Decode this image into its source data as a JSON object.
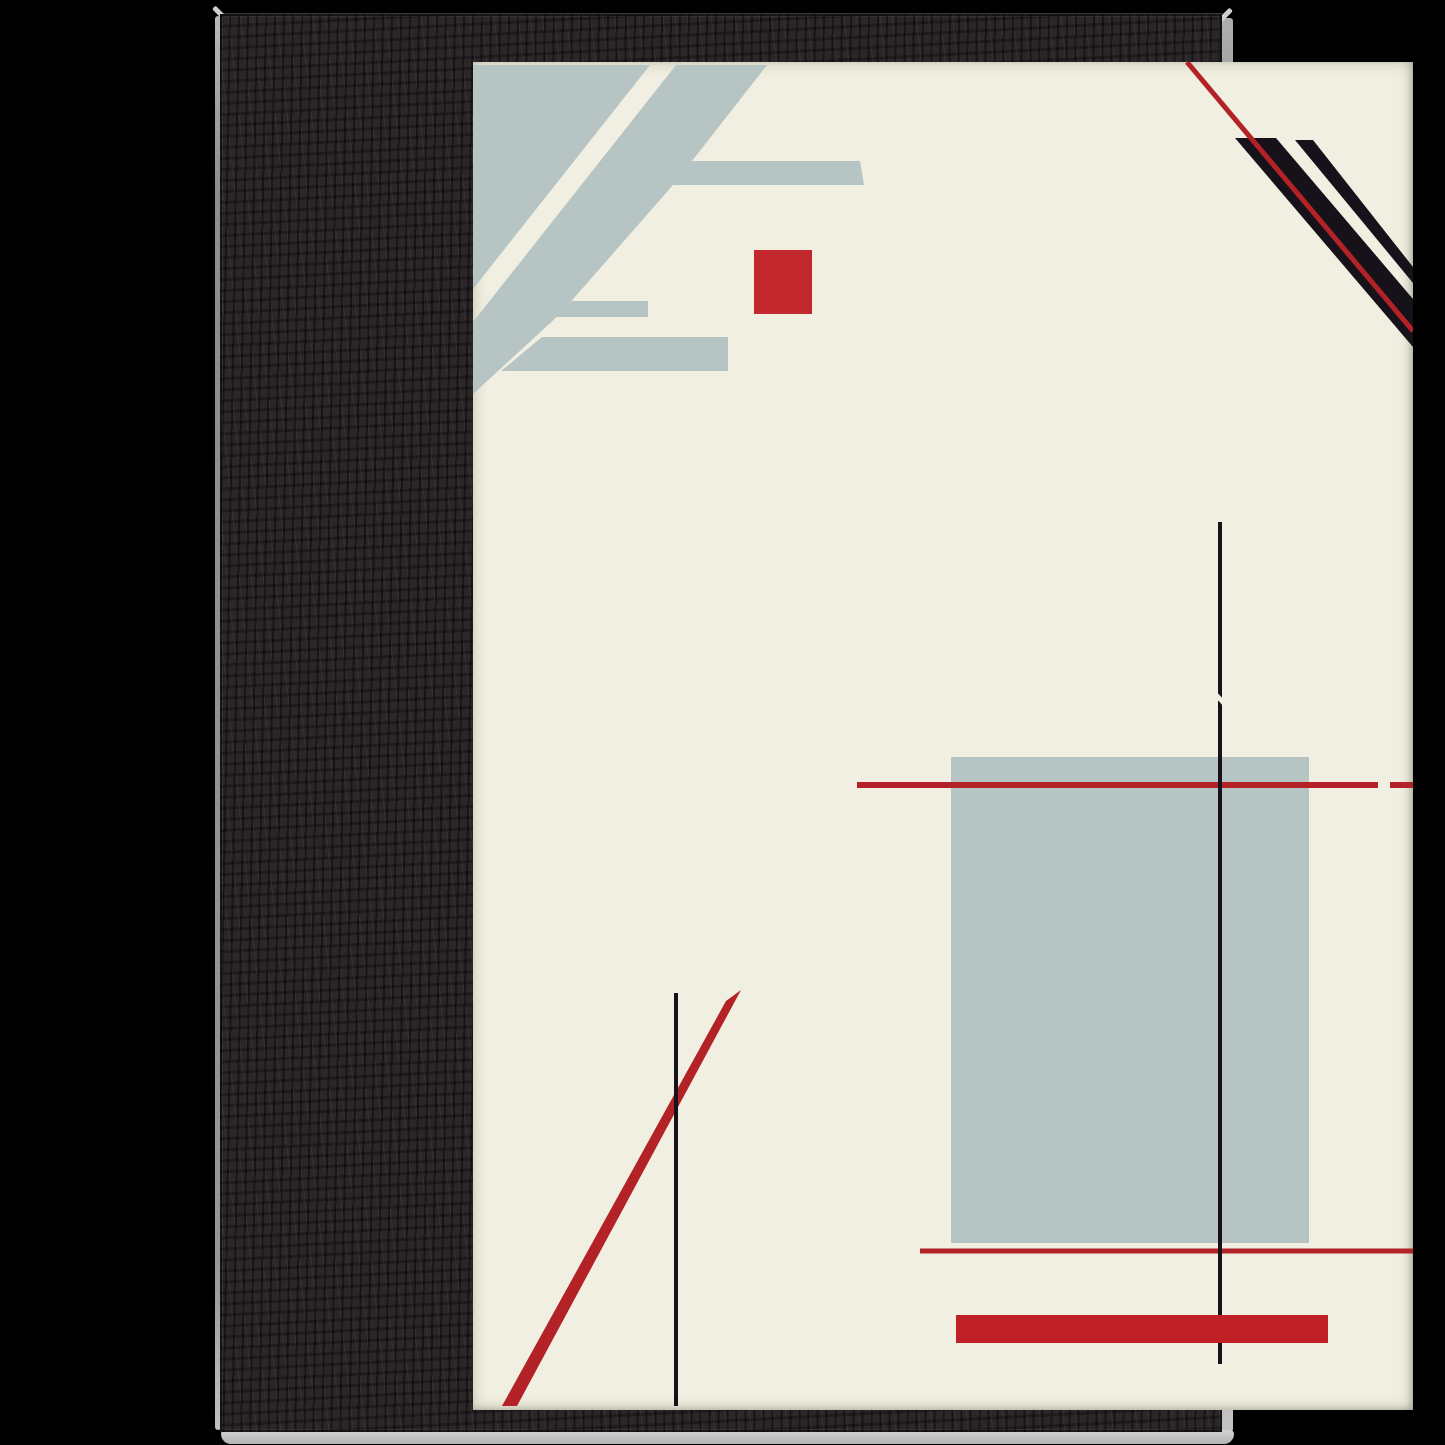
{
  "artwork": {
    "description": "Framed abstract constructivist art print, black wood frame on black background",
    "palette": {
      "background": "#000000",
      "frame": "#2b2729",
      "cream": "#f0efe1",
      "slate": "#b6c5c3",
      "ink": "#17121a",
      "red": "#b22227",
      "red_bright": "#c2282d",
      "red_deep": "#bf2127"
    },
    "poster": {
      "x": 253,
      "y": 48,
      "width": 940,
      "height": 1348
    },
    "shapes": [
      {
        "id": "topleft-corner-triangle",
        "type": "polygon",
        "fill": "slate",
        "points": "253,51 430,51 253,275"
      },
      {
        "id": "topleft-diagonal-band",
        "type": "polygon",
        "fill": "slate",
        "points": "456,51 547,51 472,147 640,147 644,171 453,171 340,300 253,380 253,308"
      },
      {
        "id": "topleft-bar-middle",
        "type": "polygon",
        "fill": "slate",
        "points": "352,287 428,287 428,303 336,303"
      },
      {
        "id": "topleft-bar-lower",
        "type": "polygon",
        "fill": "slate",
        "points": "322,323 508,323 508,357 281,357"
      },
      {
        "id": "red-square",
        "type": "rect",
        "fill": "red_bright",
        "x": 534,
        "y": 236,
        "w": 58,
        "h": 64
      },
      {
        "id": "topright-black-band",
        "type": "polygon",
        "fill": "ink",
        "points": "1015,124 1056,124 1193,285 1193,333"
      },
      {
        "id": "topright-thin-black-line",
        "type": "polygon",
        "fill": "ink",
        "points": "1075,126 1093,126 1193,253 1193,269"
      },
      {
        "id": "topright-red-stripe",
        "type": "line",
        "stroke": "red",
        "w": 5,
        "x1": 967,
        "y1": 48,
        "x2": 1193,
        "y2": 317
      },
      {
        "id": "center-gray-rectangle",
        "type": "rect",
        "fill": "slate",
        "x": 731,
        "y": 743,
        "w": 358,
        "h": 486
      },
      {
        "id": "red-horizontal-line",
        "type": "line",
        "stroke": "red",
        "w": 6,
        "x1": 637,
        "y1": 771,
        "x2": 1158,
        "y2": 771
      },
      {
        "id": "red-horizontal-line-dash",
        "type": "line",
        "stroke": "red",
        "w": 6,
        "x1": 1170,
        "y1": 771,
        "x2": 1193,
        "y2": 771
      },
      {
        "id": "lower-red-line",
        "type": "line",
        "stroke": "red",
        "w": 5,
        "x1": 700,
        "y1": 1237,
        "x2": 1193,
        "y2": 1237
      },
      {
        "id": "center-black-vline",
        "type": "line",
        "stroke": "ink",
        "w": 4,
        "x1": 1000,
        "y1": 508,
        "x2": 1000,
        "y2": 1350
      },
      {
        "id": "center-vline-notch",
        "type": "polygon",
        "fill": "cream",
        "points": "995,676 1005,687 1005,694 995,683"
      },
      {
        "id": "red-bar",
        "type": "rect",
        "fill": "red_deep",
        "x": 736,
        "y": 1301,
        "w": 372,
        "h": 28
      },
      {
        "id": "left-red-diagonal",
        "type": "polygon",
        "fill": "red",
        "points": "506,987 521,976 297,1392 282,1392"
      },
      {
        "id": "left-black-vline",
        "type": "line",
        "stroke": "ink",
        "w": 4,
        "x1": 456,
        "y1": 979,
        "x2": 456,
        "y2": 1392
      }
    ]
  }
}
